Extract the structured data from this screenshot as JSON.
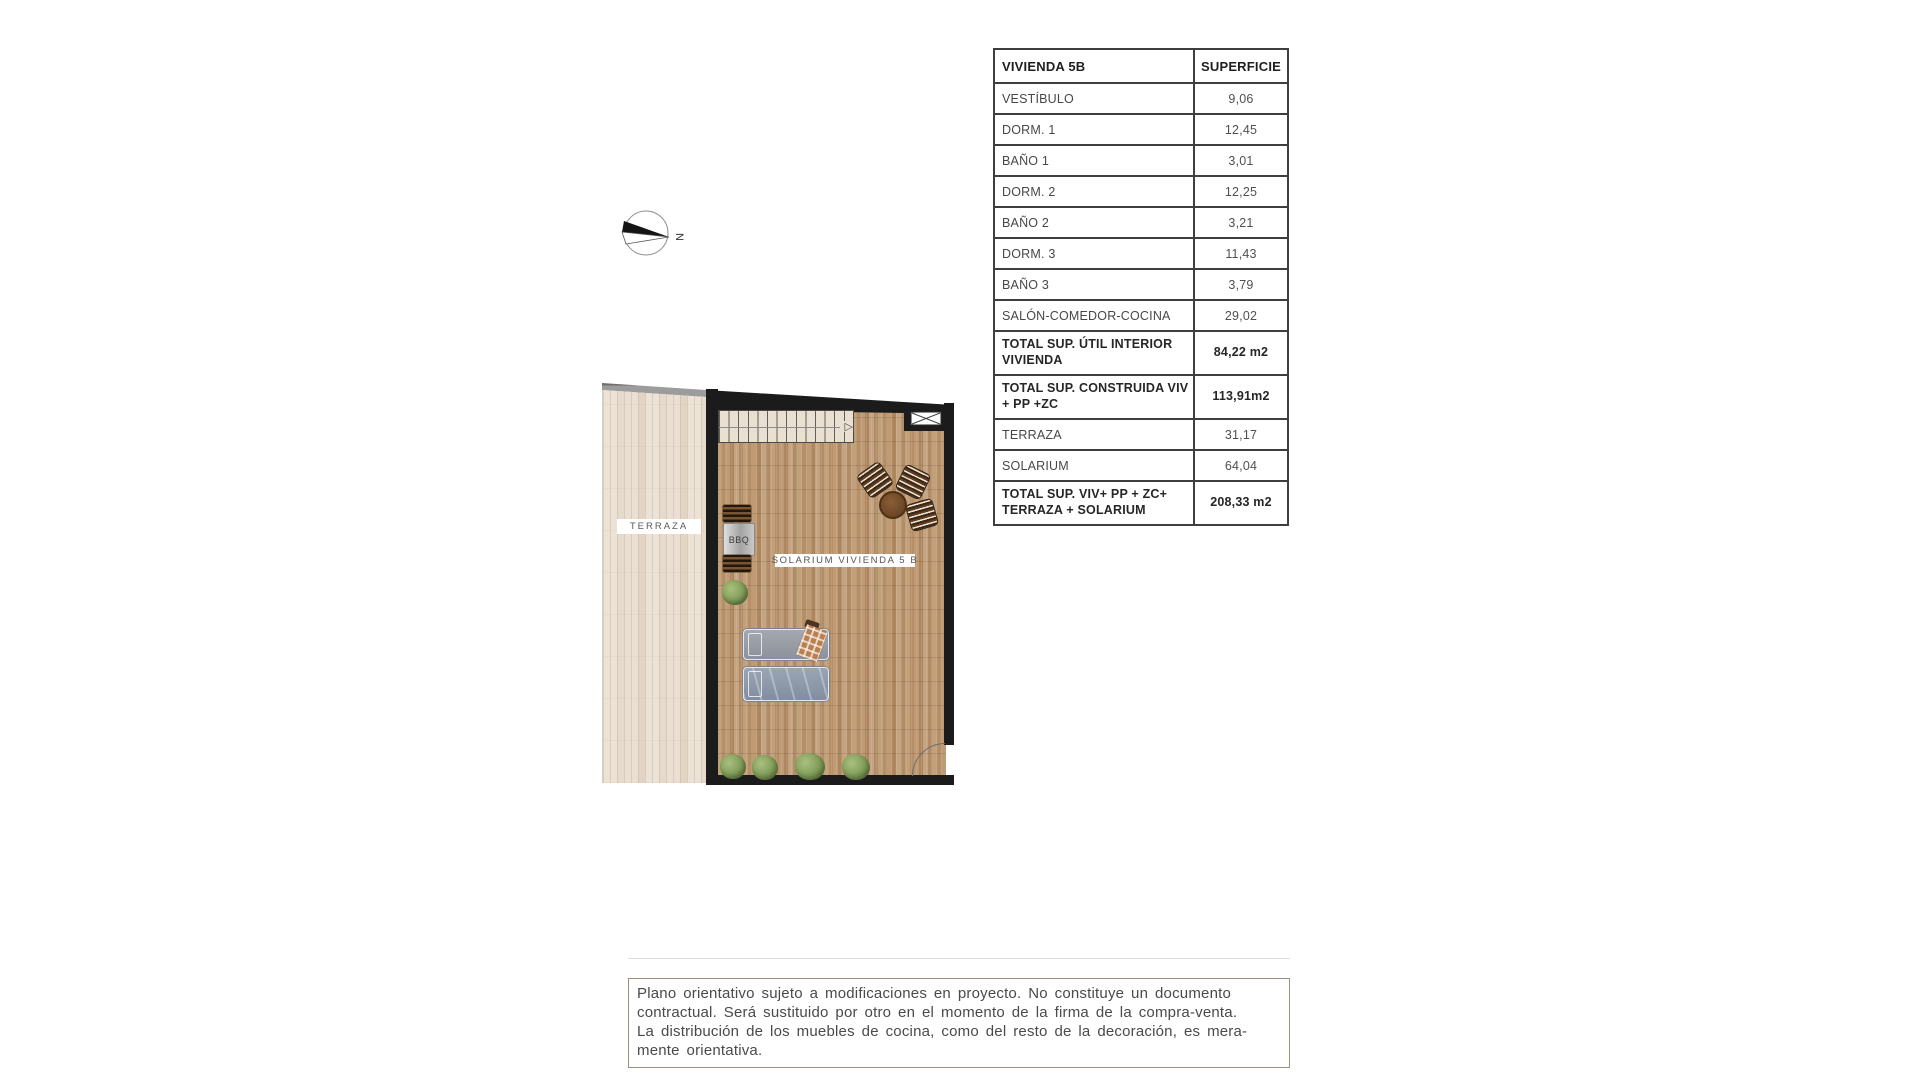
{
  "page": {
    "background": "#ffffff"
  },
  "compass": {
    "label": "N"
  },
  "table": {
    "header": {
      "name_col": "VIVIENDA 5B",
      "area_col": "SUPERFICIE"
    },
    "rows": [
      {
        "label": "VESTÍBULO",
        "value": "9,06"
      },
      {
        "label": "DORM. 1",
        "value": "12,45"
      },
      {
        "label": "BAÑO 1",
        "value": "3,01"
      },
      {
        "label": "DORM. 2",
        "value": "12,25"
      },
      {
        "label": "BAÑO 2",
        "value": "3,21"
      },
      {
        "label": "DORM. 3",
        "value": "11,43"
      },
      {
        "label": "BAÑO 3",
        "value": "3,79"
      },
      {
        "label": "SALÓN-COMEDOR-COCINA",
        "value": "29,02"
      },
      {
        "label": "TOTAL SUP. ÚTIL INTERIOR VIVIENDA",
        "value": "84,22 m2"
      },
      {
        "label": "TOTAL SUP. CONSTRUIDA VIV + PP +ZC",
        "value": "113,91m2"
      },
      {
        "label": "TERRAZA",
        "value": "31,17"
      },
      {
        "label": "SOLARIUM",
        "value": "64,04"
      },
      {
        "label": "TOTAL SUP. VIV+ PP + ZC+ TERRAZA + SOLARIUM",
        "value": "208,33 m2"
      }
    ]
  },
  "plan": {
    "terraza_label": "TERRAZA",
    "solarium_label": "SOLARIUM VIVIENDA 5 B",
    "bbq_label": "BBQ",
    "stairs_arrow": "▷"
  },
  "disclaimer": {
    "lines": [
      "Plano orientativo sujeto a modificaciones en proyecto. No constituye un documento",
      "contractual. Será sustituido por otro en el momento de la firma de la compra-venta.",
      "La distribución de los muebles de cocina, como del resto de la decoración, es mera-",
      "mente orientativa."
    ]
  },
  "colors": {
    "wall": "#1b1b1b",
    "terraza_wood": "#e9dfd2",
    "solarium_wood": "#c8a47c",
    "table_border": "#3e3e3e",
    "text": "#474747",
    "disclaimer_border": "#97937e"
  }
}
